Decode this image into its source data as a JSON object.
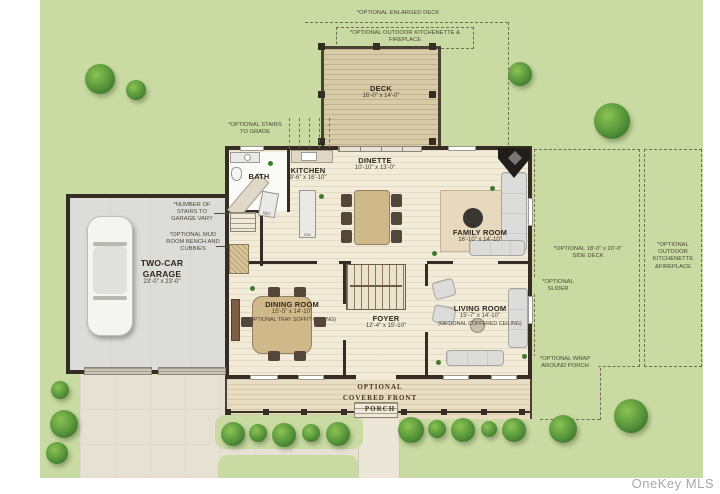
{
  "watermark": "OneKey MLS",
  "rooms": {
    "deck": {
      "name": "DECK",
      "dims": "16'-0\" x 14'-0\""
    },
    "bath": {
      "name": "BATH"
    },
    "kitchen": {
      "name": "KITCHEN",
      "dims": "9'-6\" x 16'-10\""
    },
    "dinette": {
      "name": "DINETTE",
      "dims": "10'-10\" x 13'-0\""
    },
    "family_room": {
      "name": "FAMILY ROOM",
      "dims": "16'-10\" x 14'-10\""
    },
    "garage": {
      "name": "TWO-CAR GARAGE",
      "dims": "23'-0\" x 23'-0\""
    },
    "dining_room": {
      "name": "DINING ROOM",
      "dims": "15'-5\" x 14'-10\"",
      "note": "(OPTIONAL TRAY SOFFIT CEILING)"
    },
    "foyer": {
      "name": "FOYER",
      "dims": "12'-4\" x 15'-10\""
    },
    "living_room": {
      "name": "LIVING ROOM",
      "dims": "15'-7\" x 14'-10\"",
      "note": "(OPTIONAL COFFERED CEILING)"
    }
  },
  "appliances": {
    "refrigerator": "REF",
    "dishwasher": "DW"
  },
  "annotations": {
    "enlarged_deck": "*OPTIONAL ENLARGED DECK",
    "outdoor_kitchenette_top": "*OPTIONAL OUTDOOR KITCHENETTE & FIREPLACE",
    "stairs_to_grade": "*OPTIONAL STAIRS TO GRADE",
    "stairs_vary": "*NUMBER OF STAIRS TO GARAGE VARY",
    "mud_room": "*OPTIONAL MUD ROOM BENCH AND CUBBIES",
    "side_deck": "*OPTIONAL 18'-0\" x 20'-0\" SIDE DECK",
    "outdoor_kitchenette_right": "*OPTIONAL OUTDOOR KITCHENETTE &FIREPLACE",
    "slider": "*OPTIONAL SLIDER",
    "wrap_porch": "*OPTIONAL WRAP AROUND PORCH",
    "front_porch": "OPTIONAL COVERED FRONT PORCH"
  },
  "colors": {
    "lawn": "#c9daa2",
    "floor": "#f2ebd8",
    "deck": "#d8cba8",
    "walls": "#352c23",
    "garage_floor": "#dcdcd8",
    "driveway": "#e7e1d3",
    "annotation": "#4c4a38",
    "tree": "#55933a"
  }
}
